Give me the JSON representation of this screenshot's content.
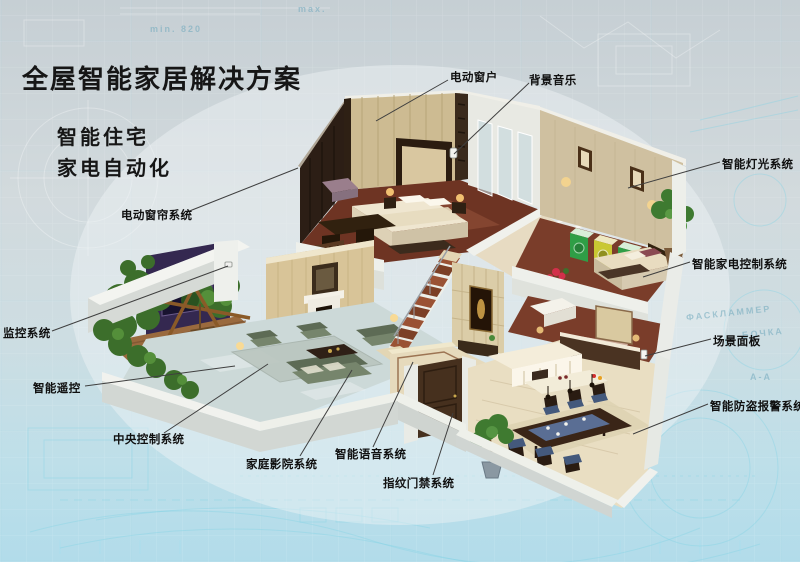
{
  "title": {
    "text": "全屋智能家居解决方案"
  },
  "subtitle": {
    "line1": "智能住宅",
    "line2": "家电自动化"
  },
  "callouts": [
    {
      "id": "electric-window",
      "text": "电动窗户"
    },
    {
      "id": "background-music",
      "text": "背景音乐"
    },
    {
      "id": "smart-lighting-system",
      "text": "智能灯光系统"
    },
    {
      "id": "smart-appliance-control",
      "text": "智能家电控制系统"
    },
    {
      "id": "scene-panel",
      "text": "场景面板"
    },
    {
      "id": "burglar-alarm-system",
      "text": "智能防盗报警系统"
    },
    {
      "id": "electric-curtain-system",
      "text": "电动窗帘系统"
    },
    {
      "id": "monitoring-system",
      "text": "监控系统"
    },
    {
      "id": "smart-remote-control",
      "text": "智能遥控"
    },
    {
      "id": "central-control-system",
      "text": "中央控制系统"
    },
    {
      "id": "home-theater-system",
      "text": "家庭影院系统"
    },
    {
      "id": "smart-voice-system",
      "text": "智能语音系统"
    },
    {
      "id": "fingerprint-access-system",
      "text": "指纹门禁系统"
    }
  ],
  "background": {
    "texture_words": [
      "min. 820",
      "max.",
      "ФАСКЛАММЕР",
      "БОЧКА",
      "А-А"
    ]
  },
  "colors": {
    "background_top": "#c6cfd4",
    "background_bottom": "#b2dcea",
    "blueprint_line": "#8fd4e6",
    "title_color": "#161616",
    "label_color": "#101010",
    "leader_line": "#3f3f3f"
  }
}
